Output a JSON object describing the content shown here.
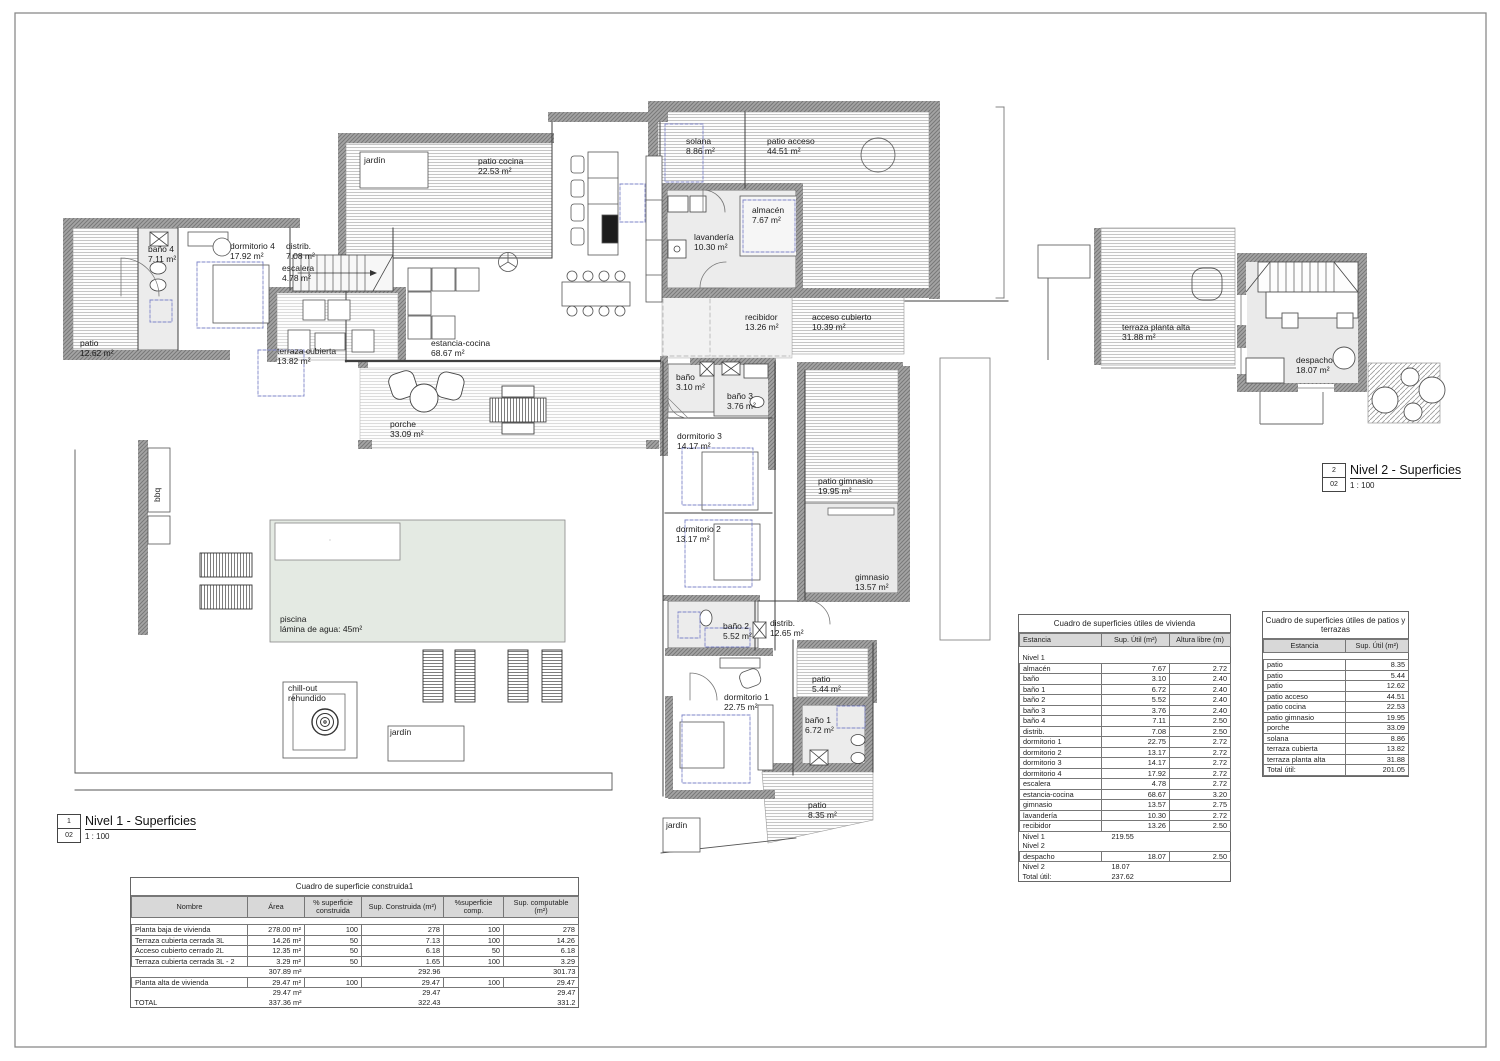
{
  "titleblocks": {
    "n1": {
      "number": "1",
      "sheet": "02",
      "title": "Nivel 1 - Superficies",
      "scale": "1 : 100"
    },
    "n2": {
      "number": "2",
      "sheet": "02",
      "title": "Nivel 2 - Superficies",
      "scale": "1 : 100"
    }
  },
  "level1": {
    "rooms": {
      "jardin_top": {
        "name": "jardín",
        "area": ""
      },
      "patio_cocina": {
        "name": "patio cocina",
        "area": "22.53 m²"
      },
      "solana": {
        "name": "solana",
        "area": "8.86 m²"
      },
      "patio_acceso": {
        "name": "patio acceso",
        "area": "44.51 m²"
      },
      "almacen": {
        "name": "almacén",
        "area": "7.67 m²"
      },
      "lavanderia": {
        "name": "lavandería",
        "area": "10.30 m²"
      },
      "bano4": {
        "name": "baño 4",
        "area": "7.11 m²"
      },
      "dormitorio4": {
        "name": "dormitorio 4",
        "area": "17.92 m²"
      },
      "distrib": {
        "name": "distrib.",
        "area": "7.08 m²"
      },
      "escalera": {
        "name": "escalera",
        "area": "4.78 m²"
      },
      "patio_izq": {
        "name": "patio",
        "area": "12.62 m²"
      },
      "terraza_cubierta": {
        "name": "terraza cubierta",
        "area": "13.82 m²"
      },
      "estancia": {
        "name": "estancia-cocina",
        "area": "68.67 m²"
      },
      "recibidor": {
        "name": "recibidor",
        "area": "13.26 m²"
      },
      "acceso_cubierto": {
        "name": "acceso cubierto",
        "area": "10.39 m²"
      },
      "bano": {
        "name": "baño",
        "area": "3.10 m²"
      },
      "bano3": {
        "name": "baño 3",
        "area": "3.76 m²"
      },
      "dormitorio3": {
        "name": "dormitorio 3",
        "area": "14.17 m²"
      },
      "patio_gimnasio": {
        "name": "patio gimnasio",
        "area": "19.95 m²"
      },
      "dormitorio2": {
        "name": "dormitorio 2",
        "area": "13.17 m²"
      },
      "gimnasio": {
        "name": "gimnasio",
        "area": "13.57 m²"
      },
      "bano2": {
        "name": "baño 2",
        "area": "5.52 m²"
      },
      "distrib2": {
        "name": "distrib.",
        "area": "12.65 m²"
      },
      "patio_544": {
        "name": "patio",
        "area": "5.44 m²"
      },
      "dormitorio1": {
        "name": "dormitorio 1",
        "area": "22.75 m²"
      },
      "bano1": {
        "name": "baño 1",
        "area": "6.72 m²"
      },
      "patio_835": {
        "name": "patio",
        "area": "8.35 m²"
      },
      "porche": {
        "name": "porche",
        "area": "33.09 m²"
      },
      "piscina": {
        "name": "piscina",
        "area": "lámina de agua: 45m²"
      },
      "chillout": {
        "name": "chill-out",
        "area": "rehundido"
      },
      "jardin_pool": {
        "name": "jardín",
        "area": ""
      },
      "jardin_bottom": {
        "name": "jardín",
        "area": ""
      },
      "bbq": {
        "name": "bbq",
        "area": ""
      }
    }
  },
  "level2": {
    "rooms": {
      "terraza_alta": {
        "name": "terraza planta alta",
        "area": "31.88 m²"
      },
      "despacho": {
        "name": "despacho",
        "area": "18.07 m²"
      }
    }
  },
  "tables": {
    "vivienda": {
      "title": "Cuadro de superficies útiles de vivienda",
      "columns": [
        "Estancia",
        "Sup. Útil (m²)",
        "Altura libre (m)"
      ],
      "rows": [
        {
          "type": "blank",
          "cells": [
            "",
            "",
            ""
          ]
        },
        {
          "type": "section",
          "cells": [
            "Nivel 1",
            "",
            ""
          ]
        },
        {
          "type": "data",
          "cells": [
            "almacén",
            "7.67",
            "2.72"
          ]
        },
        {
          "type": "data",
          "cells": [
            "baño",
            "3.10",
            "2.40"
          ]
        },
        {
          "type": "data",
          "cells": [
            "baño 1",
            "6.72",
            "2.40"
          ]
        },
        {
          "type": "data",
          "cells": [
            "baño 2",
            "5.52",
            "2.40"
          ]
        },
        {
          "type": "data",
          "cells": [
            "baño 3",
            "3.76",
            "2.40"
          ]
        },
        {
          "type": "data",
          "cells": [
            "baño 4",
            "7.11",
            "2.50"
          ]
        },
        {
          "type": "data",
          "cells": [
            "distrib.",
            "7.08",
            "2.50"
          ]
        },
        {
          "type": "data",
          "cells": [
            "dormitorio 1",
            "22.75",
            "2.72"
          ]
        },
        {
          "type": "data",
          "cells": [
            "dormitorio 2",
            "13.17",
            "2.72"
          ]
        },
        {
          "type": "data",
          "cells": [
            "dormitorio 3",
            "14.17",
            "2.72"
          ]
        },
        {
          "type": "data",
          "cells": [
            "dormitorio 4",
            "17.92",
            "2.72"
          ]
        },
        {
          "type": "data",
          "cells": [
            "escalera",
            "4.78",
            "2.72"
          ]
        },
        {
          "type": "data",
          "cells": [
            "estancia-cocina",
            "68.67",
            "3.20"
          ]
        },
        {
          "type": "data",
          "cells": [
            "gimnasio",
            "13.57",
            "2.75"
          ]
        },
        {
          "type": "data",
          "cells": [
            "lavandería",
            "10.30",
            "2.72"
          ]
        },
        {
          "type": "data",
          "cells": [
            "recibidor",
            "13.26",
            "2.50"
          ]
        },
        {
          "type": "subtotal",
          "cells": [
            "Nivel 1",
            "219.55",
            ""
          ]
        },
        {
          "type": "section",
          "cells": [
            "Nivel 2",
            "",
            ""
          ]
        },
        {
          "type": "data",
          "cells": [
            "despacho",
            "18.07",
            "2.50"
          ]
        },
        {
          "type": "subtotal",
          "cells": [
            "Nivel 2",
            "18.07",
            ""
          ]
        },
        {
          "type": "subtotal",
          "cells": [
            "Total útil:",
            "237.62",
            ""
          ]
        }
      ]
    },
    "patios": {
      "title": "Cuadro de superficies útiles de patios y terrazas",
      "columns": [
        "Estancia",
        "Sup. Útil (m²)"
      ],
      "rows": [
        {
          "type": "blank",
          "cells": [
            "",
            ""
          ]
        },
        {
          "type": "data",
          "cells": [
            "patio",
            "8.35"
          ]
        },
        {
          "type": "data",
          "cells": [
            "patio",
            "5.44"
          ]
        },
        {
          "type": "data",
          "cells": [
            "patio",
            "12.62"
          ]
        },
        {
          "type": "data",
          "cells": [
            "patio acceso",
            "44.51"
          ]
        },
        {
          "type": "data",
          "cells": [
            "patio cocina",
            "22.53"
          ]
        },
        {
          "type": "data",
          "cells": [
            "patio gimnasio",
            "19.95"
          ]
        },
        {
          "type": "data",
          "cells": [
            "porche",
            "33.09"
          ]
        },
        {
          "type": "data",
          "cells": [
            "solana",
            "8.86"
          ]
        },
        {
          "type": "data",
          "cells": [
            "terraza cubierta",
            "13.82"
          ]
        },
        {
          "type": "data",
          "cells": [
            "terraza planta alta",
            "31.88"
          ]
        },
        {
          "type": "data",
          "cells": [
            "Total útil:",
            "201.05"
          ]
        }
      ]
    },
    "construida": {
      "title": "Cuadro de superficie construida1",
      "columns": [
        "Nombre",
        "Área",
        "% superficie construida",
        "Sup. Construida (m²)",
        "%superficie comp.",
        "Sup. computable (m²)"
      ],
      "rows": [
        {
          "type": "blank",
          "cells": [
            "",
            "",
            "",
            "",
            "",
            ""
          ]
        },
        {
          "type": "data",
          "cells": [
            "Planta baja de vivienda",
            "278.00 m²",
            "100",
            "278",
            "100",
            "278"
          ]
        },
        {
          "type": "data",
          "cells": [
            "Terraza cubierta cerrada 3L",
            "14.26 m²",
            "50",
            "7.13",
            "100",
            "14.26"
          ]
        },
        {
          "type": "data",
          "cells": [
            "Acceso cubierto cerrado 2L",
            "12.35 m²",
            "50",
            "6.18",
            "50",
            "6.18"
          ]
        },
        {
          "type": "data",
          "cells": [
            "Terraza cubierta cerrada 3L - 2",
            "3.29 m²",
            "50",
            "1.65",
            "100",
            "3.29"
          ]
        },
        {
          "type": "subtotal",
          "cells": [
            "",
            "307.89 m²",
            "",
            "292.96",
            "",
            "301.73"
          ]
        },
        {
          "type": "data",
          "cells": [
            "Planta alta de vivienda",
            "29.47 m²",
            "100",
            "29.47",
            "100",
            "29.47"
          ]
        },
        {
          "type": "subtotal",
          "cells": [
            "",
            "29.47 m²",
            "",
            "29.47",
            "",
            "29.47"
          ]
        },
        {
          "type": "subtotal",
          "cells": [
            "TOTAL",
            "337.36 m²",
            "",
            "322.43",
            "",
            "331.2"
          ]
        }
      ]
    }
  }
}
